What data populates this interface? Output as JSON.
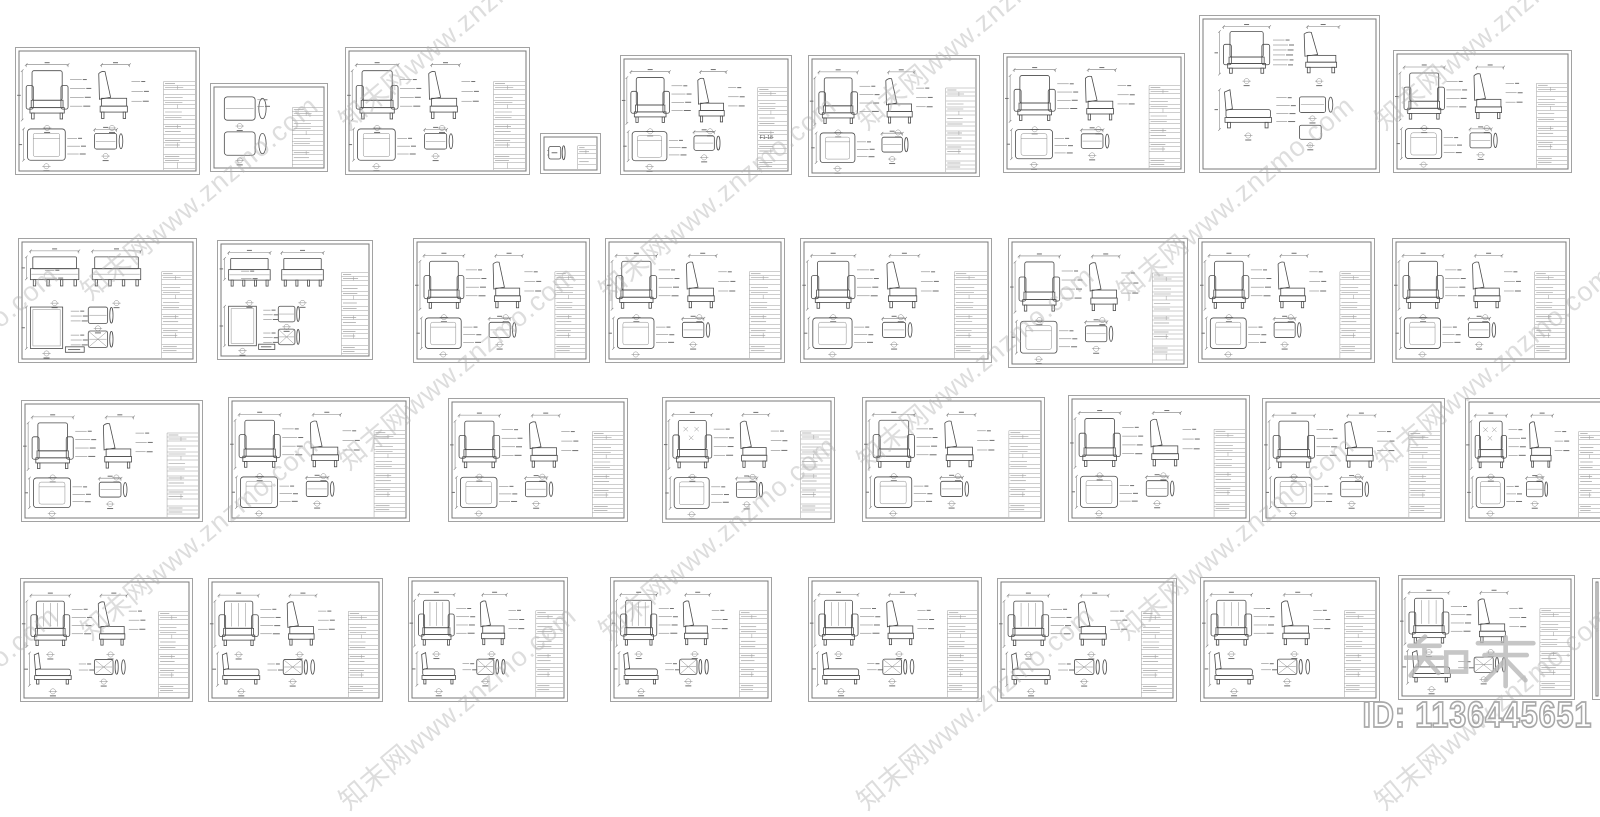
{
  "page": {
    "width": 1600,
    "height": 755,
    "background": "#ffffff"
  },
  "watermark": {
    "text": "知末网www.znzmo.com",
    "color": "#aeaeae",
    "angle_deg": -40,
    "positions": [
      [
        -62,
        26
      ],
      [
        456,
        26
      ],
      [
        974,
        26
      ],
      [
        1492,
        26
      ],
      [
        198,
        196
      ],
      [
        716,
        196
      ],
      [
        1234,
        196
      ],
      [
        -62,
        366
      ],
      [
        456,
        366
      ],
      [
        974,
        366
      ],
      [
        1492,
        366
      ],
      [
        198,
        536
      ],
      [
        716,
        536
      ],
      [
        1234,
        536
      ],
      [
        -62,
        706
      ],
      [
        456,
        706
      ],
      [
        974,
        706
      ],
      [
        1492,
        706
      ]
    ]
  },
  "logo_watermark": {
    "text": "知末",
    "outline_color": "#b8b8b8",
    "x": 1404,
    "y": 626,
    "width": 132,
    "height": 78
  },
  "id_label": {
    "text": "ID: 1136445651",
    "outline_color": "#a9a9a9"
  },
  "colors": {
    "sheet_outer_border": "#a2a2a2",
    "sheet_inner_border": "#787878",
    "drawing_line": "#4b4b4b",
    "dimension_line": "#7d7d7d",
    "title_block_line": "#9d9d9d"
  },
  "sheets": [
    {
      "id": "r1s1",
      "x": 15,
      "y": 47,
      "w": 185,
      "h": 128,
      "variant": "pair",
      "title_block": true
    },
    {
      "id": "r1s2",
      "x": 210,
      "y": 83,
      "w": 118,
      "h": 89,
      "variant": "mini",
      "title_block": true
    },
    {
      "id": "r1s3",
      "x": 345,
      "y": 47,
      "w": 185,
      "h": 128,
      "variant": "pair",
      "title_block": true
    },
    {
      "id": "r1s4",
      "x": 540,
      "y": 133,
      "w": 61,
      "h": 41,
      "variant": "tiny",
      "title_block": true
    },
    {
      "id": "r1s5",
      "x": 620,
      "y": 55,
      "w": 172,
      "h": 120,
      "variant": "pair",
      "title_block": true,
      "code": "F1-18"
    },
    {
      "id": "r1s6",
      "x": 808,
      "y": 55,
      "w": 172,
      "h": 122,
      "variant": "pair",
      "title_block": true
    },
    {
      "id": "r1s7",
      "x": 1003,
      "y": 53,
      "w": 182,
      "h": 120,
      "variant": "pair",
      "title_block": true
    },
    {
      "id": "r1s8",
      "x": 1199,
      "y": 15,
      "w": 181,
      "h": 158,
      "variant": "tall",
      "title_block": false
    },
    {
      "id": "r1s9",
      "x": 1393,
      "y": 50,
      "w": 179,
      "h": 123,
      "variant": "pair",
      "title_block": true
    },
    {
      "id": "r2s1",
      "x": 18,
      "y": 238,
      "w": 179,
      "h": 125,
      "variant": "bench",
      "title_block": true
    },
    {
      "id": "r2s2",
      "x": 217,
      "y": 240,
      "w": 156,
      "h": 120,
      "variant": "bench",
      "title_block": true
    },
    {
      "id": "r2s3",
      "x": 413,
      "y": 238,
      "w": 177,
      "h": 125,
      "variant": "pair",
      "title_block": true
    },
    {
      "id": "r2s4",
      "x": 605,
      "y": 238,
      "w": 180,
      "h": 125,
      "variant": "pair",
      "title_block": true
    },
    {
      "id": "r2s5",
      "x": 800,
      "y": 238,
      "w": 192,
      "h": 125,
      "variant": "pair",
      "title_block": true
    },
    {
      "id": "r2s6",
      "x": 1008,
      "y": 238,
      "w": 180,
      "h": 130,
      "variant": "pair",
      "title_block": true
    },
    {
      "id": "r2s7",
      "x": 1198,
      "y": 238,
      "w": 177,
      "h": 125,
      "variant": "pair",
      "title_block": true
    },
    {
      "id": "r2s8",
      "x": 1392,
      "y": 238,
      "w": 178,
      "h": 125,
      "variant": "pair",
      "title_block": true
    },
    {
      "id": "r3s1",
      "x": 21,
      "y": 400,
      "w": 182,
      "h": 122,
      "variant": "pair",
      "title_block": true
    },
    {
      "id": "r3s2",
      "x": 228,
      "y": 397,
      "w": 182,
      "h": 125,
      "variant": "pair",
      "title_block": true
    },
    {
      "id": "r3s3",
      "x": 448,
      "y": 398,
      "w": 180,
      "h": 124,
      "variant": "pair",
      "title_block": true
    },
    {
      "id": "r3s4",
      "x": 662,
      "y": 397,
      "w": 173,
      "h": 126,
      "variant": "pair",
      "title_block": true,
      "tuft": true
    },
    {
      "id": "r3s5",
      "x": 862,
      "y": 397,
      "w": 183,
      "h": 125,
      "variant": "pair",
      "title_block": true
    },
    {
      "id": "r3s6",
      "x": 1068,
      "y": 395,
      "w": 182,
      "h": 127,
      "variant": "pair",
      "title_block": true
    },
    {
      "id": "r3s7",
      "x": 1262,
      "y": 398,
      "w": 183,
      "h": 124,
      "variant": "pair",
      "title_block": true
    },
    {
      "id": "r3s8",
      "x": 1465,
      "y": 398,
      "w": 143,
      "h": 124,
      "variant": "pair",
      "title_block": true,
      "tuft": true
    },
    {
      "id": "r4s1",
      "x": 20,
      "y": 578,
      "w": 173,
      "h": 124,
      "variant": "lounge",
      "title_block": true
    },
    {
      "id": "r4s2",
      "x": 208,
      "y": 578,
      "w": 175,
      "h": 124,
      "variant": "lounge",
      "title_block": true
    },
    {
      "id": "r4s3",
      "x": 408,
      "y": 577,
      "w": 160,
      "h": 125,
      "variant": "lounge",
      "title_block": true
    },
    {
      "id": "r4s4",
      "x": 610,
      "y": 577,
      "w": 162,
      "h": 125,
      "variant": "lounge",
      "title_block": true
    },
    {
      "id": "r4s5",
      "x": 808,
      "y": 577,
      "w": 174,
      "h": 125,
      "variant": "lounge",
      "title_block": true
    },
    {
      "id": "r4s6",
      "x": 997,
      "y": 578,
      "w": 180,
      "h": 124,
      "variant": "lounge",
      "title_block": true
    },
    {
      "id": "r4s7",
      "x": 1200,
      "y": 577,
      "w": 180,
      "h": 125,
      "variant": "lounge",
      "title_block": true
    },
    {
      "id": "r4s8",
      "x": 1398,
      "y": 575,
      "w": 177,
      "h": 125,
      "variant": "lounge",
      "title_block": true
    },
    {
      "id": "r4s9",
      "x": 1592,
      "y": 578,
      "w": 10,
      "h": 122,
      "variant": "sliver",
      "title_block": false
    }
  ]
}
